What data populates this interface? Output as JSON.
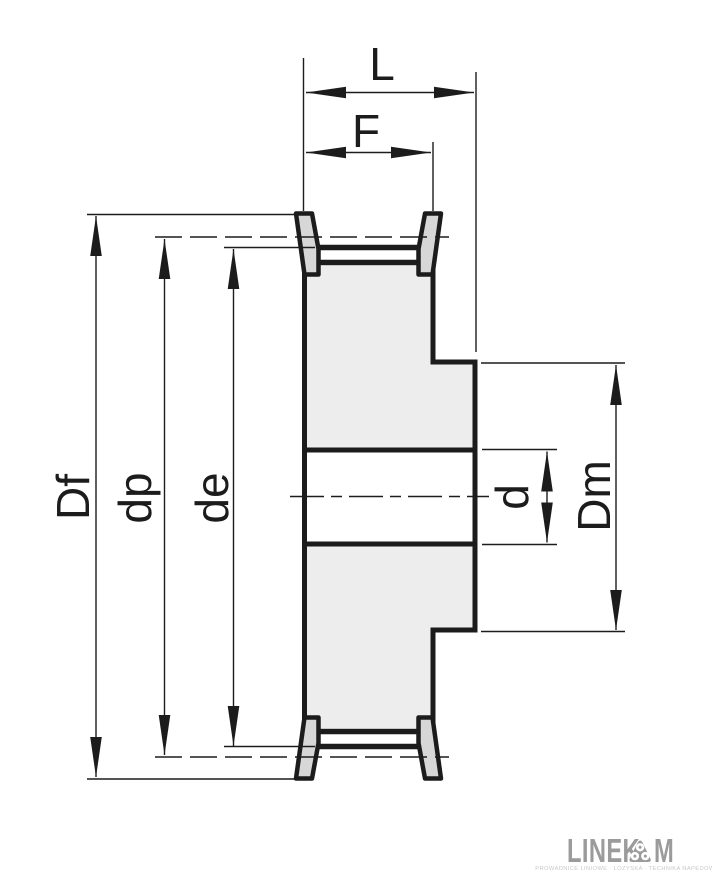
{
  "drawing": {
    "labels": {
      "L": "L",
      "F": "F",
      "Df": "Df",
      "dp": "dp",
      "de": "de",
      "d": "d",
      "Dm": "Dm"
    },
    "colors": {
      "line": "#1c1c1c",
      "body_fill": "#ededed",
      "flange_fill": "#d7d7d7",
      "logo_gray": "#9b9b9b",
      "tagline_gray": "#c9c9c9",
      "paper": "#ffffff"
    }
  },
  "logo": {
    "text_before_symbol": "LINEK",
    "text_after_symbol": "M",
    "symbol": "pulley-triangle-circles-icon",
    "tagline_microtext": "PROWADNICE LINIOWE · LOZYSKA · TECHNIKA NAPEDOWA"
  }
}
